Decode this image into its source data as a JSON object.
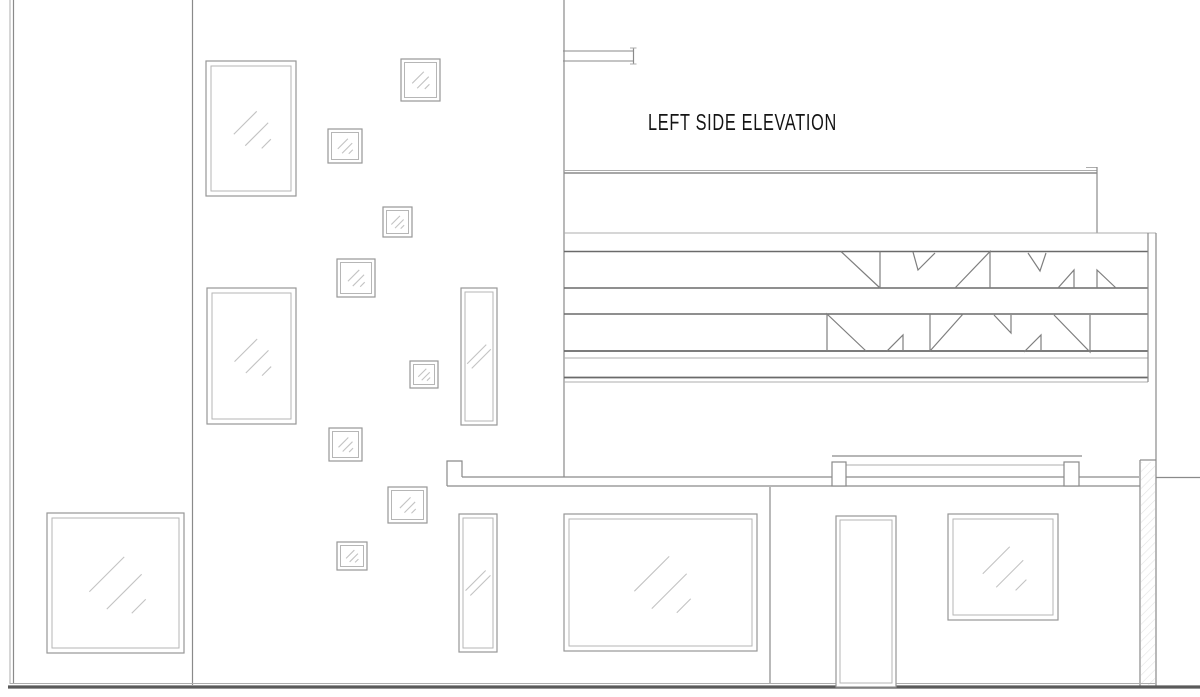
{
  "title": {
    "text": "LEFT SIDE ELEVATION"
  },
  "canvas": {
    "width": 1200,
    "height": 697,
    "background": "#ffffff"
  },
  "colors": {
    "wall": "#8a8a8a",
    "thin": "#adadad",
    "heavy": "#6a6a6a",
    "frame": "#979797",
    "frame_inner": "#b6b6b6",
    "glass": "#c3c3c3",
    "ground": "#5a5a5a",
    "hatch": "#e3e3e3",
    "truss": "#7e7e7e",
    "text": "#141414"
  },
  "window_styles": {
    "large": {
      "inset": 5,
      "mark": 0.36,
      "marks": 3
    },
    "small": {
      "inset": 3.5,
      "mark": 0.42,
      "marks": 3
    },
    "tall": {
      "inset": 4,
      "mark": 0.75,
      "marks": 2
    },
    "door": {
      "inset": 4,
      "mark": 0,
      "marks": 0
    }
  },
  "windows": [
    {
      "name": "window-portrait-upper",
      "x": 206,
      "y": 61,
      "w": 90,
      "h": 135,
      "kind": "large"
    },
    {
      "name": "window-portrait-lower",
      "x": 207,
      "y": 288,
      "w": 89,
      "h": 136,
      "kind": "large"
    },
    {
      "name": "window-ground-left",
      "x": 47,
      "y": 513,
      "w": 137,
      "h": 140,
      "kind": "large"
    },
    {
      "name": "window-square-1",
      "x": 401,
      "y": 59,
      "w": 39,
      "h": 42,
      "kind": "small"
    },
    {
      "name": "window-square-2",
      "x": 328,
      "y": 129,
      "w": 34,
      "h": 34,
      "kind": "small"
    },
    {
      "name": "window-square-3",
      "x": 383,
      "y": 207,
      "w": 29,
      "h": 30,
      "kind": "small"
    },
    {
      "name": "window-square-4",
      "x": 337,
      "y": 259,
      "w": 38,
      "h": 38,
      "kind": "small"
    },
    {
      "name": "window-square-5",
      "x": 410,
      "y": 361,
      "w": 28,
      "h": 27,
      "kind": "small"
    },
    {
      "name": "window-square-6",
      "x": 329,
      "y": 428,
      "w": 33,
      "h": 33,
      "kind": "small"
    },
    {
      "name": "window-square-7",
      "x": 388,
      "y": 487,
      "w": 39,
      "h": 36,
      "kind": "small"
    },
    {
      "name": "window-square-8",
      "x": 337,
      "y": 542,
      "w": 30,
      "h": 28,
      "kind": "small"
    },
    {
      "name": "window-slim-upper",
      "x": 461,
      "y": 288,
      "w": 36,
      "h": 137,
      "kind": "tall"
    },
    {
      "name": "window-slim-lower",
      "x": 459,
      "y": 514,
      "w": 38,
      "h": 138,
      "kind": "tall"
    },
    {
      "name": "window-ground-center",
      "x": 564,
      "y": 514,
      "w": 193,
      "h": 137,
      "kind": "large"
    },
    {
      "name": "window-ground-right",
      "x": 948,
      "y": 514,
      "w": 110,
      "h": 106,
      "kind": "large"
    },
    {
      "name": "entry-door",
      "x": 836,
      "y": 516,
      "w": 60,
      "h": 171,
      "kind": "door"
    }
  ],
  "lines": [
    {
      "name": "left-wall-outer-line",
      "x1": 10,
      "y1": 0,
      "x2": 10,
      "y2": 684,
      "c": "thin",
      "w": 1
    },
    {
      "name": "left-wall-inner-line",
      "x1": 13.5,
      "y1": 0,
      "x2": 13.5,
      "y2": 684,
      "c": "wall",
      "w": 1.2
    },
    {
      "name": "mid-wall-line",
      "x1": 192.5,
      "y1": 0,
      "x2": 192.5,
      "y2": 685,
      "c": "wall",
      "w": 1.2
    },
    {
      "name": "tower-right-wall-line",
      "x1": 564,
      "y1": 0,
      "x2": 564,
      "y2": 477,
      "c": "wall",
      "w": 1.2
    },
    {
      "name": "canopy-top-line",
      "x1": 563,
      "y1": 51,
      "x2": 634,
      "y2": 51,
      "c": "wall",
      "w": 1.1
    },
    {
      "name": "canopy-bottom-line",
      "x1": 563,
      "y1": 61,
      "x2": 634,
      "y2": 61,
      "c": "wall",
      "w": 1.1
    },
    {
      "name": "canopy-end-plate",
      "x1": 633.5,
      "y1": 48,
      "x2": 633.5,
      "y2": 64,
      "c": "wall",
      "w": 1.2
    },
    {
      "name": "canopy-end-tick-top",
      "x1": 630,
      "y1": 48,
      "x2": 636.5,
      "y2": 48,
      "c": "thin",
      "w": 1
    },
    {
      "name": "canopy-end-tick-bottom",
      "x1": 630,
      "y1": 64,
      "x2": 636.5,
      "y2": 64,
      "c": "thin",
      "w": 1
    },
    {
      "name": "roof-upper-line",
      "x1": 564,
      "y1": 170.5,
      "x2": 1097,
      "y2": 170.5,
      "c": "thin",
      "w": 1
    },
    {
      "name": "roof-lower-line",
      "x1": 564,
      "y1": 173,
      "x2": 1097,
      "y2": 173,
      "c": "wall",
      "w": 1.5
    },
    {
      "name": "roof-end-tick",
      "x1": 1086,
      "y1": 167.5,
      "x2": 1097,
      "y2": 167.5,
      "c": "thin",
      "w": 1
    },
    {
      "name": "roof-step-line",
      "x1": 1097,
      "y1": 167,
      "x2": 1097,
      "y2": 233,
      "c": "wall",
      "w": 1.2
    },
    {
      "name": "band-top-outer-line",
      "x1": 564,
      "y1": 233,
      "x2": 1156,
      "y2": 233,
      "c": "thin",
      "w": 1
    },
    {
      "name": "band1-top-chord",
      "x1": 564,
      "y1": 251.5,
      "x2": 1148,
      "y2": 251.5,
      "c": "heavy",
      "w": 1.5
    },
    {
      "name": "band1-bottom-chord",
      "x1": 564,
      "y1": 288,
      "x2": 1148,
      "y2": 288,
      "c": "heavy",
      "w": 1.5
    },
    {
      "name": "band2-top-chord",
      "x1": 564,
      "y1": 314,
      "x2": 1148,
      "y2": 314,
      "c": "heavy",
      "w": 1.5
    },
    {
      "name": "band2-bottom-chord",
      "x1": 564,
      "y1": 351,
      "x2": 1148,
      "y2": 351,
      "c": "heavy",
      "w": 1.8
    },
    {
      "name": "band2-bottom-inner",
      "x1": 564,
      "y1": 358,
      "x2": 1148,
      "y2": 358,
      "c": "thin",
      "w": 1
    },
    {
      "name": "band-lower-fascia",
      "x1": 564,
      "y1": 377.5,
      "x2": 1148,
      "y2": 377.5,
      "c": "heavy",
      "w": 1.8
    },
    {
      "name": "band-lower-fascia-inner",
      "x1": 564,
      "y1": 382,
      "x2": 1148,
      "y2": 382,
      "c": "thin",
      "w": 1
    },
    {
      "name": "band-end-inner-line",
      "x1": 1148,
      "y1": 233,
      "x2": 1148,
      "y2": 382,
      "c": "wall",
      "w": 1.2
    },
    {
      "name": "right-wall-upper-line",
      "x1": 1156,
      "y1": 233,
      "x2": 1156,
      "y2": 460,
      "c": "wall",
      "w": 1.2
    },
    {
      "name": "fascia-top-line",
      "x1": 462,
      "y1": 477,
      "x2": 1139,
      "y2": 477,
      "c": "wall",
      "w": 1.2
    },
    {
      "name": "fascia-top-right-line",
      "x1": 1156,
      "y1": 477.5,
      "x2": 1200,
      "y2": 477.5,
      "c": "wall",
      "w": 1.2
    },
    {
      "name": "fascia-bottom-line",
      "x1": 447,
      "y1": 486,
      "x2": 1140,
      "y2": 486,
      "c": "wall",
      "w": 1.2
    },
    {
      "name": "parapet-top-line",
      "x1": 832,
      "y1": 456,
      "x2": 1082,
      "y2": 456,
      "c": "wall",
      "w": 1.2
    },
    {
      "name": "parapet-inner-line",
      "x1": 846,
      "y1": 465,
      "x2": 1064,
      "y2": 465,
      "c": "thin",
      "w": 1
    },
    {
      "name": "block-left-edge-line",
      "x1": 770,
      "y1": 487,
      "x2": 770,
      "y2": 684,
      "c": "wall",
      "w": 1.2
    },
    {
      "name": "column-cap-line",
      "x1": 1140,
      "y1": 460,
      "x2": 1156,
      "y2": 460,
      "c": "wall",
      "w": 1.2
    },
    {
      "name": "column-left-line",
      "x1": 1140,
      "y1": 460,
      "x2": 1140,
      "y2": 686,
      "c": "wall",
      "w": 1.2
    },
    {
      "name": "column-right-line",
      "x1": 1156,
      "y1": 460,
      "x2": 1156,
      "y2": 686,
      "c": "wall",
      "w": 1.2
    },
    {
      "name": "ground-upper-line",
      "x1": 10,
      "y1": 683.5,
      "x2": 1156,
      "y2": 683.5,
      "c": "thin",
      "w": 1
    },
    {
      "name": "ground-line",
      "x1": 8,
      "y1": 687,
      "x2": 1200,
      "y2": 687,
      "c": "ground",
      "w": 3.2
    }
  ],
  "paths": [
    {
      "name": "wall-cap-step",
      "d": "M 447 486 L 447 461 L 462 461 L 462 477",
      "c": "wall",
      "w": 1.2
    }
  ],
  "outline_rects": [
    {
      "name": "parapet-block-left",
      "x": 832,
      "y": 462,
      "w": 14,
      "h": 24,
      "c": "wall",
      "w2": 1.2
    },
    {
      "name": "parapet-block-right",
      "x": 1064,
      "y": 462,
      "w": 15,
      "h": 24,
      "c": "wall",
      "w2": 1.2
    }
  ],
  "truss_shapes": [
    {
      "name": "truss-triangle",
      "pts": [
        [
          841,
          251.5
        ],
        [
          880,
          288
        ]
      ]
    },
    {
      "name": "truss-triangle",
      "pts": [
        [
          880,
          251.5
        ],
        [
          880,
          288
        ]
      ]
    },
    {
      "name": "truss-triangle",
      "pts": [
        [
          913,
          252
        ],
        [
          918,
          270
        ],
        [
          935,
          253
        ]
      ]
    },
    {
      "name": "truss-triangle",
      "pts": [
        [
          955,
          288
        ],
        [
          990,
          251.5
        ],
        [
          990,
          288
        ]
      ]
    },
    {
      "name": "truss-triangle",
      "pts": [
        [
          1028,
          253
        ],
        [
          1040,
          271
        ],
        [
          1046,
          253
        ]
      ]
    },
    {
      "name": "truss-triangle",
      "pts": [
        [
          1058,
          288
        ],
        [
          1074,
          270
        ],
        [
          1074,
          288
        ]
      ]
    },
    {
      "name": "truss-triangle",
      "pts": [
        [
          1097,
          288
        ],
        [
          1097,
          270
        ],
        [
          1116,
          288
        ]
      ]
    },
    {
      "name": "truss-triangle",
      "pts": [
        [
          827,
          351
        ],
        [
          827,
          314
        ],
        [
          866,
          351
        ]
      ]
    },
    {
      "name": "truss-triangle",
      "pts": [
        [
          887,
          351
        ],
        [
          903,
          335
        ],
        [
          903,
          351
        ]
      ]
    },
    {
      "name": "truss-triangle",
      "pts": [
        [
          930,
          314
        ],
        [
          930,
          351
        ]
      ]
    },
    {
      "name": "truss-triangle",
      "pts": [
        [
          930,
          351
        ],
        [
          963,
          314
        ]
      ]
    },
    {
      "name": "truss-triangle",
      "pts": [
        [
          994,
          315
        ],
        [
          1011,
          333
        ],
        [
          1011,
          315
        ]
      ]
    },
    {
      "name": "truss-triangle",
      "pts": [
        [
          1024,
          352
        ],
        [
          1041,
          335
        ],
        [
          1041,
          352
        ]
      ]
    },
    {
      "name": "truss-triangle",
      "pts": [
        [
          1054,
          315
        ],
        [
          1090,
          352
        ],
        [
          1090,
          315
        ]
      ]
    }
  ],
  "hatch_region": {
    "name": "wall-hatch",
    "x": 1141,
    "y": 462,
    "w": 14,
    "h": 223
  }
}
